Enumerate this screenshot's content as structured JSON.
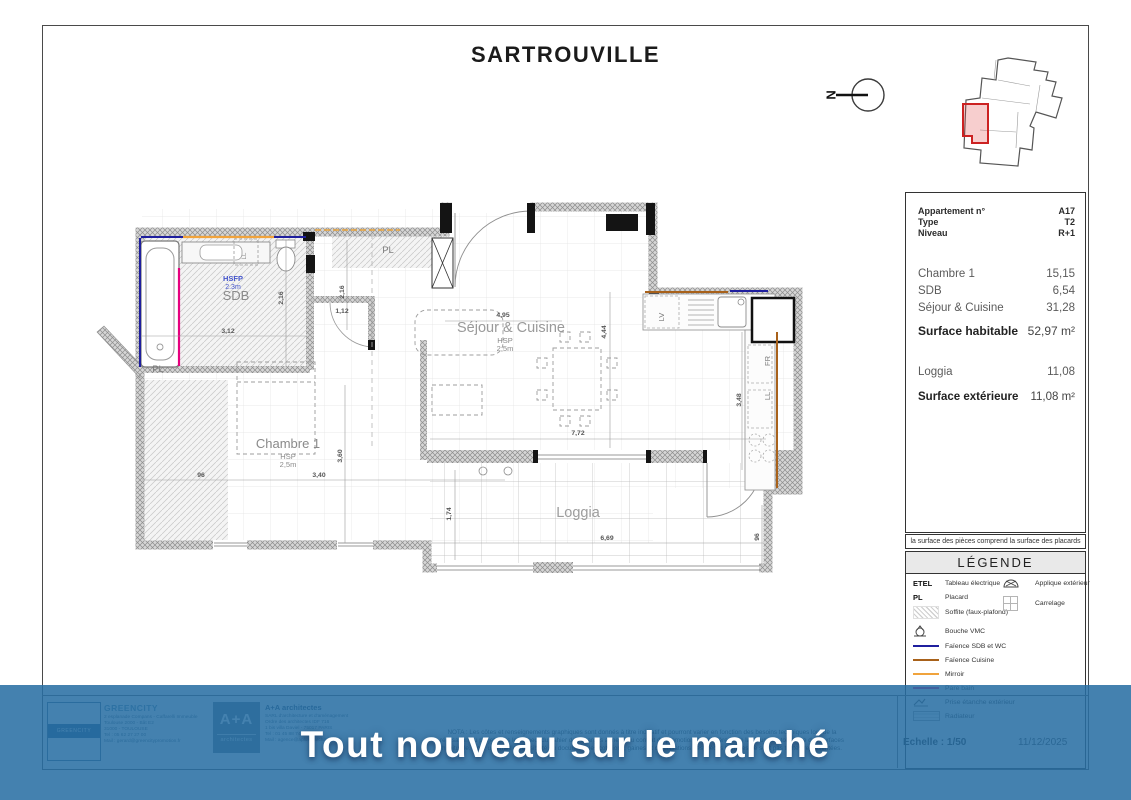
{
  "title": "SARTROUVILLE",
  "north": {
    "letter": "N"
  },
  "banner": {
    "text": "Tout nouveau sur le marché"
  },
  "info_panel": {
    "header_rows": [
      {
        "label": "Appartement n°",
        "value": "A17"
      },
      {
        "label": "Type",
        "value": "T2"
      },
      {
        "label": "Niveau",
        "value": "R+1"
      }
    ],
    "room_rows": [
      {
        "label": "Chambre 1",
        "value": "15,15"
      },
      {
        "label": "SDB",
        "value": "6,54"
      },
      {
        "label": "Séjour & Cuisine",
        "value": "31,28"
      }
    ],
    "surface_habitable": {
      "label": "Surface habitable",
      "value": "52,97 m²"
    },
    "loggia_row": {
      "label": "Loggia",
      "value": "11,08"
    },
    "surface_exterieure": {
      "label": "Surface extérieure",
      "value": "11,08 m²"
    },
    "footnote": "la surface des pièces comprend la surface des placards"
  },
  "legend": {
    "title": "LÉGENDE",
    "left_items": [
      {
        "key": "ETEL",
        "label": "Tableau électrique"
      },
      {
        "key": "PL",
        "label": "Placard"
      },
      {
        "label": "Soffite (faux-plafond)"
      },
      {
        "label": "Bouche VMC"
      },
      {
        "label": "Faïence SDB et WC",
        "style": "border-top:2.2px solid #1f1f9e"
      },
      {
        "label": "Faïence Cuisine",
        "style": "border-top:2.2px solid #a8611a"
      },
      {
        "label": "Mirroir",
        "style": "border-top:2.2px solid #f0a33c"
      },
      {
        "label": "Pare bain",
        "style": "border-top:2.2px solid #e6007e"
      },
      {
        "label": "Prise étanche extérieur"
      },
      {
        "label": "Radiateur"
      }
    ],
    "right_items": [
      {
        "label": "Applique extérieur"
      },
      {
        "label": "Carrelage"
      }
    ]
  },
  "plan": {
    "room_labels": {
      "sdb": "SDB",
      "sdb_h1": "HSFP",
      "sdb_h2": "2.3m",
      "pl_top": "PL",
      "pl_left": "PL",
      "ll_sdb": "LL",
      "sejour": "Séjour & Cuisine",
      "sejour_h1": "HSP",
      "sejour_h2": "2,5m",
      "chambre": "Chambre 1",
      "chambre_h1": "HSP",
      "chambre_h2": "2,5m",
      "loggia": "Loggia",
      "lv": "LV",
      "fr": "FR",
      "ll_cuisine": "LL"
    },
    "dims": [
      "3,12",
      "2,16",
      "1,12",
      "2,16",
      "4,95",
      "4,44",
      "7,72",
      "96",
      "3,40",
      "3,60",
      "1,74",
      "6,69",
      "96",
      "3,48"
    ]
  },
  "footer": {
    "greencity": {
      "logo_text": "GREENCITY",
      "name": "GREENCITY",
      "lines": [
        "2 esplanade Compans - Caffarelli  Immeuble",
        "Toulouse 2000 - Bât E2",
        "31000 - TOULOUSE",
        "Tel : 05 62 27 27 00",
        "Mail : gerard@greencitypromotion.fr"
      ]
    },
    "architect": {
      "logo_main": "A+A",
      "logo_sub": "architectes",
      "name": "A+A architectes",
      "lines": [
        "SARL d'architecture et d'aménagement",
        "Ordre des architectes IDF 716",
        "1 bis villa Daviel - 75017 PARIS",
        "Tel : 01 45 88 74 56",
        "Mail : agence@aplusa-architectes.fr"
      ]
    },
    "nota_lines": [
      "NOTA : Les côtes et renseignements graphiques sont donnés à titre indicatif et pourront varier en fonction des besoins techniques lors de la",
      "réalisation du projet dans le respect du cahier des charges annexé au contrat de promotion immobilière et de la clause de tolérance des surfaces",
      "habituelle. Pour une meilleure lisibilité du document, les cotations, gaines et canalisations des pièces humides ne sont pas toutes représentées."
    ],
    "scale_label": "Echelle : 1/50",
    "date": "11/12/2025"
  }
}
